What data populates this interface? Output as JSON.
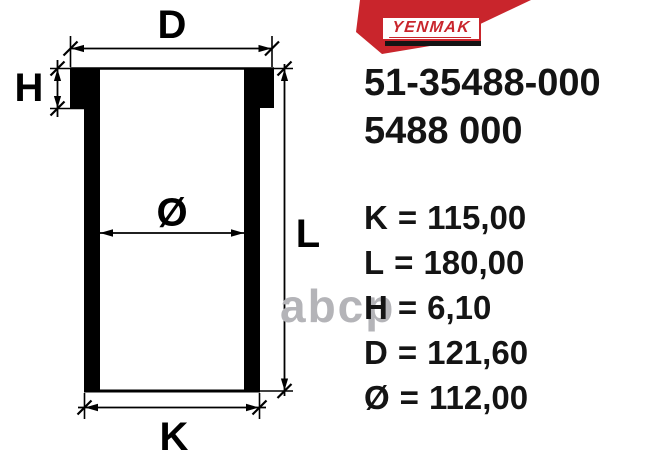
{
  "brand": {
    "name": "YENMAK"
  },
  "part_numbers": {
    "primary": "51-35488-000",
    "secondary": "5488 000"
  },
  "drawing": {
    "labels": {
      "d": "D",
      "h": "H",
      "bore": "Ø",
      "l": "L",
      "k": "K"
    }
  },
  "specs": [
    {
      "symbol": "K",
      "eq": "=",
      "value": "115,00"
    },
    {
      "symbol": "L",
      "eq": "=",
      "value": "180,00"
    },
    {
      "symbol": "H",
      "eq": "=",
      "value": "6,10"
    },
    {
      "symbol": "D",
      "eq": "=",
      "value": "121,60"
    },
    {
      "symbol": "Ø",
      "eq": "=",
      "value": "112,00"
    }
  ],
  "watermark": "abcp",
  "colors": {
    "accent_red": "#c9252c",
    "text_black": "#141414",
    "watermark_gray": "#b4b4b8"
  }
}
